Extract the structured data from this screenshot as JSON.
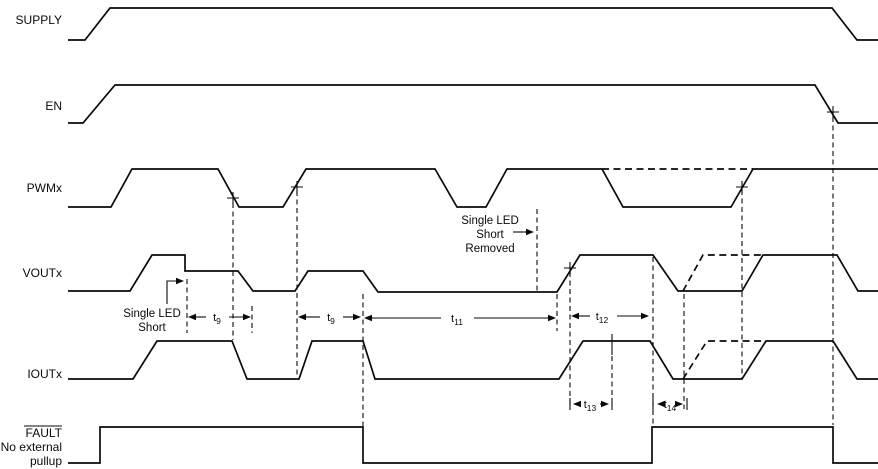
{
  "diagram_type": "timing-diagram",
  "colors": {
    "line": "#0a0a0a",
    "background": "#ffffff"
  },
  "signals": {
    "supply": {
      "label": "SUPPLY"
    },
    "en": {
      "label": "EN"
    },
    "pwm": {
      "label": "PWMx"
    },
    "vout": {
      "label": "VOUTx"
    },
    "iout": {
      "label": "IOUTx"
    },
    "fault": {
      "label": "FAULT",
      "note_line1": "No external",
      "note_line2": "pullup"
    }
  },
  "annotations": {
    "short": {
      "line1": "Single LED",
      "line2": "Short"
    },
    "short_removed": {
      "line1": "Single LED",
      "line2": "Short",
      "line3": "Removed"
    }
  },
  "timing": {
    "t9": {
      "base": "t",
      "sub": "9"
    },
    "t11": {
      "base": "t",
      "sub": "11"
    },
    "t12": {
      "base": "t",
      "sub": "12"
    },
    "t13": {
      "base": "t",
      "sub": "13"
    },
    "t14": {
      "base": "t",
      "sub": "14"
    }
  }
}
